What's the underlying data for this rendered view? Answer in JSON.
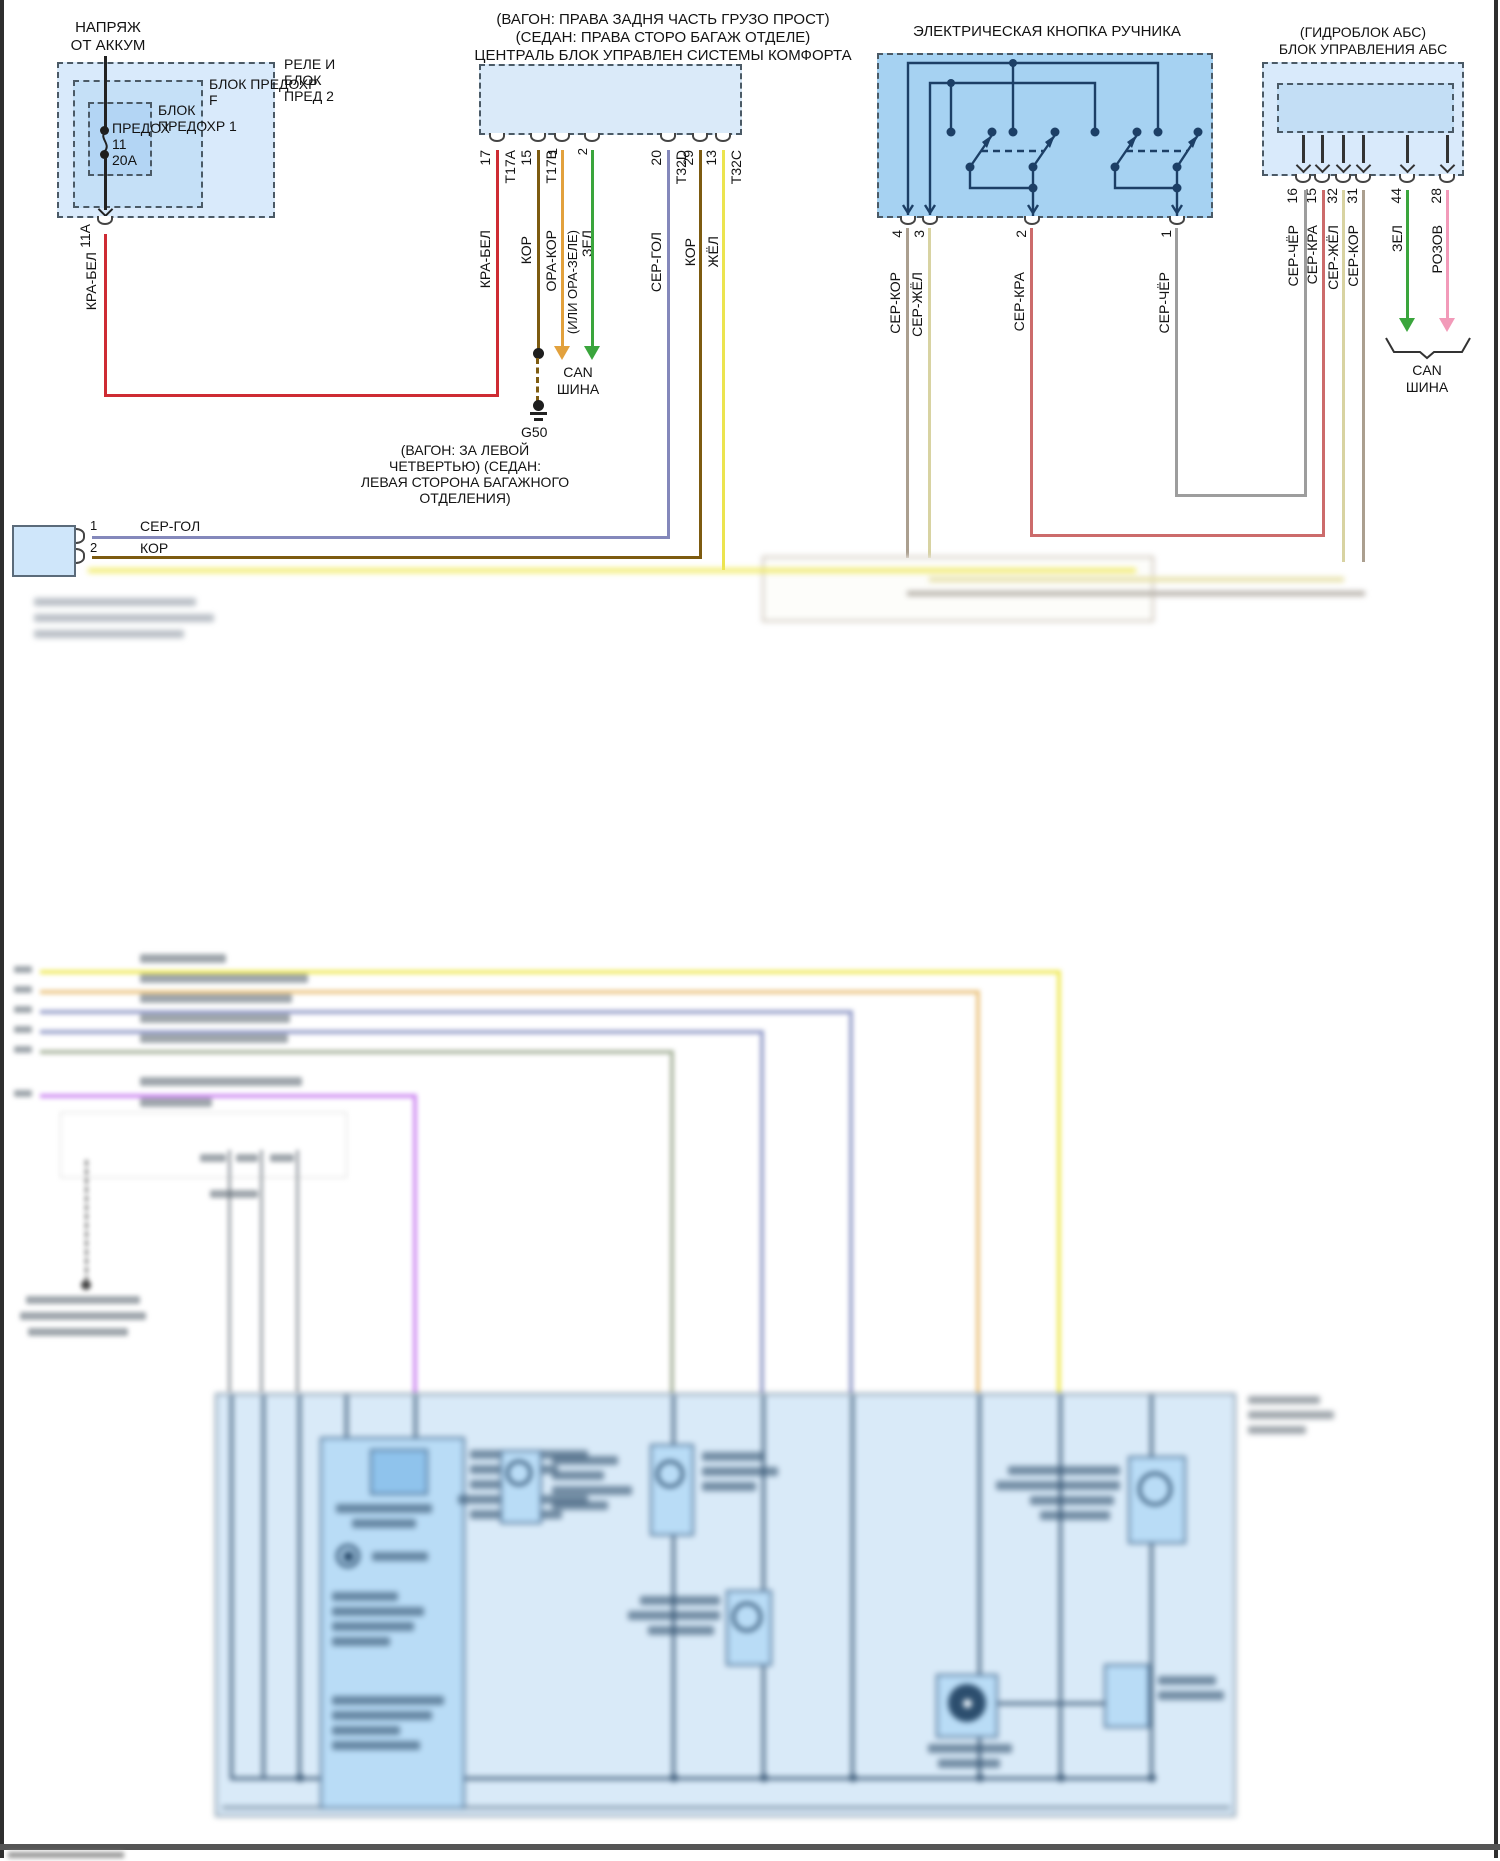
{
  "page": {
    "type": "автосхема — электрический стояночный тормоз"
  },
  "colors": {
    "kra_bel": "#ce2b33",
    "kor": "#7d5b10",
    "ora_kor": "#e2a13d",
    "zel": "#3aa53c",
    "ser_gol": "#8488bb",
    "zhel": "#ece44f",
    "ser_kor": "#ab9f8f",
    "ser_zhel": "#d8d3a2",
    "ser_kra": "#cc6b6b",
    "ser_cher": "#9d9d9d",
    "rozov": "#f29ab9",
    "circuit": "#1c3f66",
    "box_light": "#d9eafb",
    "box_mid": "#c5e0f7",
    "box_inner": "#b3d5f4",
    "button_fill": "#a6d2f2"
  },
  "battery": {
    "source_line1": "НАПРЯЖ",
    "source_line2": "ОТ АККУМ",
    "relay_line1": "РЕЛЕ И",
    "relay_line2": "БЛОК",
    "relay_line3": "ПРЕД 2",
    "panel_line1": "БЛОК ПРЕДОХР",
    "panel_line2": "F",
    "block1_line1": "БЛОК",
    "block1_line2": "ПРЕДОХР 1",
    "fuse_name": "ПРЕДОХ",
    "fuse_num": "11",
    "fuse_amp": "20А",
    "pin": "11А",
    "wire": "КРА-БЕЛ"
  },
  "comfort": {
    "title1": "(ВАГОН: ПРАВА ЗАДНЯ ЧАСТЬ ГРУЗО ПРОСТ)",
    "title2": "(СЕДАН: ПРАВА СТОРО БАГАЖ ОТДЕЛЕ)",
    "title3": "ЦЕНТРАЛЬ БЛОК УПРАВЛЕН СИСТЕМЫ КОМФОРТА",
    "pins": [
      {
        "num": "17",
        "conn": "Т17А",
        "wire": "КРА-БЕЛ"
      },
      {
        "num": "15",
        "conn": "Т17В",
        "wire": "КОР"
      },
      {
        "num": "1",
        "wire": "ОРА-КОР",
        "alt": "(ИЛИ ОРА-ЗЕЛЕ)"
      },
      {
        "num": "2",
        "wire": "ЗЕЛ"
      },
      {
        "num": "20",
        "conn": "Т32D",
        "wire": "СЕР-ГОЛ"
      },
      {
        "num": "29",
        "wire": "КОР"
      },
      {
        "num": "13",
        "conn": "Т32С",
        "wire": "ЖЁЛ"
      }
    ],
    "can1": "CAN",
    "can2": "ШИНА",
    "ground_id": "G50",
    "ground_note1": "(ВАГОН: ЗА ЛЕВОЙ",
    "ground_note2": "ЧЕТВЕРТЬЮ) (СЕДАН:",
    "ground_note3": "ЛЕВАЯ СТОРОНА БАГАЖНОГО",
    "ground_note4": "ОТДЕЛЕНИЯ)"
  },
  "connector": {
    "pin1": "1",
    "wire1": "СЕР-ГОЛ",
    "pin2": "2",
    "wire2": "КОР"
  },
  "button": {
    "title": "ЭЛЕКТРИЧЕСКАЯ КНОПКА РУЧНИКА",
    "pins": [
      {
        "num": "4",
        "wire": "СЕР-КОР"
      },
      {
        "num": "3",
        "wire": "СЕР-ЖЁЛ"
      },
      {
        "num": "2",
        "wire": "СЕР-КРА"
      },
      {
        "num": "1",
        "wire": "СЕР-ЧЁР"
      }
    ]
  },
  "abs": {
    "title1": "(ГИДРОБЛОК АБС)",
    "title2": "БЛОК УПРАВЛЕНИЯ АБС",
    "pins": [
      {
        "num": "16",
        "wire": "СЕР-ЧЁР"
      },
      {
        "num": "15",
        "wire": "СЕР-КРА"
      },
      {
        "num": "32",
        "wire": "СЕР-ЖЁЛ"
      },
      {
        "num": "31",
        "wire": "СЕР-КОР"
      },
      {
        "num": "44",
        "wire": "ЗЕЛ"
      },
      {
        "num": "28",
        "wire": "РОЗОВ"
      }
    ],
    "can1": "CAN",
    "can2": "ШИНА"
  }
}
